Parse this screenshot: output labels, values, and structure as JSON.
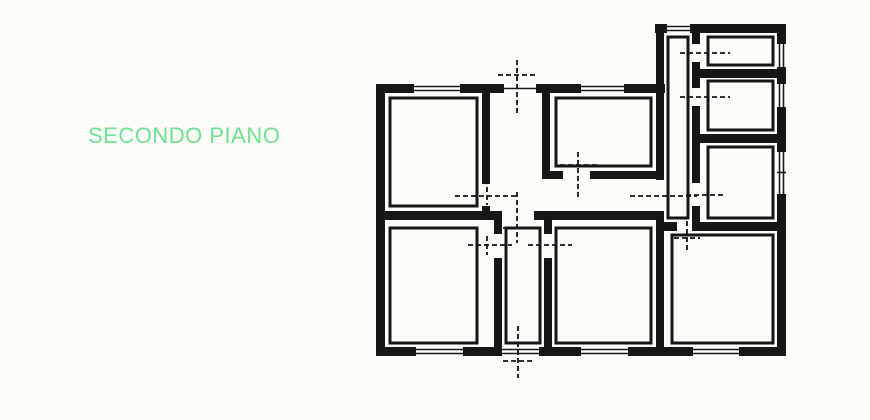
{
  "page": {
    "background": "#fbfbf8"
  },
  "label": {
    "text": "SECONDO PIANO",
    "color": "#70e191"
  },
  "floorplan": {
    "ink": "#161616",
    "paper": "#ffffff",
    "walls": [
      [
        376,
        84,
        9,
        272
      ],
      [
        376,
        84,
        38,
        9
      ],
      [
        460,
        84,
        44,
        9
      ],
      [
        536,
        84,
        45,
        9
      ],
      [
        624,
        84,
        41,
        9
      ],
      [
        655,
        24,
        12,
        9
      ],
      [
        690,
        24,
        96,
        9
      ],
      [
        777,
        24,
        9,
        20
      ],
      [
        777,
        67,
        9,
        17
      ],
      [
        777,
        107,
        9,
        45
      ],
      [
        777,
        194,
        9,
        162
      ],
      [
        376,
        347,
        40,
        9
      ],
      [
        463,
        347,
        39,
        9
      ],
      [
        539,
        347,
        42,
        9
      ],
      [
        628,
        347,
        65,
        9
      ],
      [
        739,
        347,
        47,
        9
      ],
      [
        656,
        24,
        8,
        156
      ],
      [
        656,
        211,
        8,
        145
      ],
      [
        692,
        33,
        8,
        11
      ],
      [
        692,
        62,
        8,
        26
      ],
      [
        692,
        106,
        8,
        77
      ],
      [
        692,
        206,
        8,
        25
      ],
      [
        700,
        69,
        77,
        9
      ],
      [
        700,
        134,
        77,
        9
      ],
      [
        664,
        222,
        13,
        9
      ],
      [
        697,
        222,
        80,
        9
      ],
      [
        385,
        211,
        117,
        9
      ],
      [
        534,
        211,
        122,
        9
      ],
      [
        482,
        93,
        8,
        91
      ],
      [
        482,
        206,
        8,
        5
      ],
      [
        542,
        93,
        8,
        86
      ],
      [
        542,
        171,
        21,
        8
      ],
      [
        590,
        171,
        66,
        8
      ],
      [
        494,
        220,
        8,
        14
      ],
      [
        494,
        258,
        8,
        89
      ],
      [
        544,
        220,
        8,
        14
      ],
      [
        544,
        258,
        8,
        89
      ]
    ],
    "rooms": [
      {
        "name": "top-left-room",
        "rect": [
          390,
          98,
          87,
          108
        ]
      },
      {
        "name": "inner-bath-room",
        "rect": [
          556,
          98,
          95,
          68
        ]
      },
      {
        "name": "corridor",
        "rect": [
          668,
          37,
          20,
          181
        ]
      },
      {
        "name": "right-room-1",
        "rect": [
          708,
          37,
          65,
          28
        ]
      },
      {
        "name": "right-room-2",
        "rect": [
          708,
          81,
          65,
          49
        ]
      },
      {
        "name": "right-room-3",
        "rect": [
          708,
          147,
          65,
          71
        ]
      },
      {
        "name": "bottom-left-room",
        "rect": [
          390,
          228,
          87,
          115
        ]
      },
      {
        "name": "small-hall",
        "rect": [
          506,
          228,
          34,
          115
        ]
      },
      {
        "name": "bottom-middle-room",
        "rect": [
          556,
          228,
          95,
          115
        ]
      },
      {
        "name": "bottom-right-room",
        "rect": [
          672,
          235,
          101,
          108
        ]
      }
    ],
    "window_openings": [
      [
        414,
        84,
        46,
        9
      ],
      [
        581,
        84,
        43,
        9
      ],
      [
        504,
        84,
        32,
        9
      ],
      [
        667,
        24,
        23,
        9
      ],
      [
        777,
        44,
        9,
        23
      ],
      [
        777,
        84,
        9,
        23
      ],
      [
        777,
        152,
        9,
        42
      ],
      [
        416,
        347,
        47,
        9
      ],
      [
        502,
        347,
        37,
        9
      ],
      [
        581,
        347,
        47,
        9
      ],
      [
        693,
        347,
        46,
        9
      ]
    ],
    "window_lines": [
      [
        414,
        86.5,
        460,
        86.5
      ],
      [
        414,
        90.5,
        460,
        90.5
      ],
      [
        581,
        86.5,
        624,
        86.5
      ],
      [
        581,
        90.5,
        624,
        90.5
      ],
      [
        504,
        88.5,
        536,
        88.5
      ],
      [
        667,
        26.5,
        690,
        26.5
      ],
      [
        667,
        30.5,
        690,
        30.5
      ],
      [
        779.5,
        44,
        779.5,
        67
      ],
      [
        783.5,
        44,
        783.5,
        67
      ],
      [
        779.5,
        84,
        779.5,
        107
      ],
      [
        783.5,
        84,
        783.5,
        107
      ],
      [
        779.5,
        152,
        779.5,
        194
      ],
      [
        783.5,
        152,
        783.5,
        194
      ],
      [
        777,
        172.5,
        786,
        172.5
      ],
      [
        416,
        349.5,
        463,
        349.5
      ],
      [
        416,
        353.5,
        463,
        353.5
      ],
      [
        502,
        349.5,
        539,
        349.5
      ],
      [
        502,
        353.5,
        539,
        353.5
      ],
      [
        581,
        349.5,
        628,
        349.5
      ],
      [
        581,
        353.5,
        628,
        353.5
      ],
      [
        693,
        349.5,
        739,
        349.5
      ],
      [
        693,
        353.5,
        739,
        353.5
      ]
    ],
    "door_markers": [
      [
        517,
        60,
        517,
        114
      ],
      [
        498,
        75,
        536,
        75
      ],
      [
        455,
        196,
        519,
        196
      ],
      [
        487,
        187,
        487,
        205
      ],
      [
        630,
        196,
        697,
        196
      ],
      [
        517,
        192,
        517,
        243
      ],
      [
        503,
        228,
        533,
        228
      ],
      [
        468,
        245,
        512,
        245
      ],
      [
        487,
        236,
        487,
        255
      ],
      [
        528,
        245,
        572,
        245
      ],
      [
        556,
        236,
        556,
        255
      ],
      [
        518,
        326,
        518,
        378
      ],
      [
        503,
        361,
        535,
        361
      ],
      [
        680,
        53,
        730,
        53
      ],
      [
        680,
        97,
        730,
        97
      ],
      [
        686,
        195,
        726,
        195
      ],
      [
        687,
        221,
        687,
        252
      ],
      [
        674,
        238,
        700,
        238
      ],
      [
        578,
        152,
        578,
        200
      ],
      [
        560,
        165,
        598,
        165
      ]
    ]
  }
}
